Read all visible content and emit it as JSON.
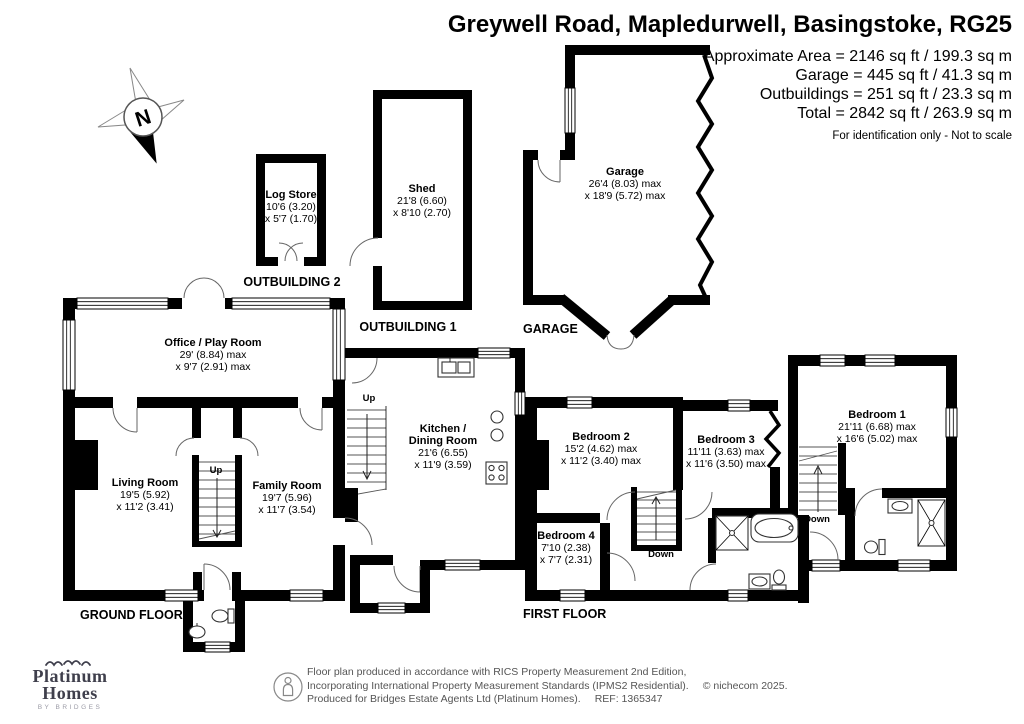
{
  "title": "Greywell Road, Mapledurwell, Basingstoke, RG25",
  "areas": {
    "approximate": "Approximate Area = 2146 sq ft / 199.3 sq m",
    "garage": "Garage = 445 sq ft / 41.3 sq m",
    "outbuildings": "Outbuildings = 251 sq ft / 23.3 sq m",
    "total": "Total = 2842 sq ft / 263.9 sq m",
    "disclaimer": "For identification only - Not to scale"
  },
  "compass": {
    "north": "N"
  },
  "rooms": {
    "log_store": {
      "name": "Log Store",
      "dim1": "10'6 (3.20)",
      "dim2": "x 5'7 (1.70)"
    },
    "shed": {
      "name": "Shed",
      "dim1": "21'8 (6.60)",
      "dim2": "x 8'10 (2.70)"
    },
    "garage": {
      "name": "Garage",
      "dim1": "26'4 (8.03) max",
      "dim2": "x 18'9 (5.72) max"
    },
    "office_play_room": {
      "name": "Office / Play Room",
      "dim1": "29' (8.84) max",
      "dim2": "x 9'7 (2.91) max"
    },
    "kitchen_dining": {
      "name": "Kitchen /",
      "name2": "Dining Room",
      "dim1": "21'6 (6.55)",
      "dim2": "x 11'9 (3.59)"
    },
    "living_room": {
      "name": "Living Room",
      "dim1": "19'5 (5.92)",
      "dim2": "x 11'2 (3.41)"
    },
    "family_room": {
      "name": "Family Room",
      "dim1": "19'7 (5.96)",
      "dim2": "x 11'7 (3.54)"
    },
    "bedroom_1": {
      "name": "Bedroom 1",
      "dim1": "21'11 (6.68) max",
      "dim2": "x 16'6 (5.02) max"
    },
    "bedroom_2": {
      "name": "Bedroom 2",
      "dim1": "15'2 (4.62) max",
      "dim2": "x 11'2 (3.40) max"
    },
    "bedroom_3": {
      "name": "Bedroom 3",
      "dim1": "11'11 (3.63) max",
      "dim2": "x 11'6 (3.50) max"
    },
    "bedroom_4": {
      "name": "Bedroom 4",
      "dim1": "7'10 (2.38)",
      "dim2": "x 7'7 (2.31)"
    }
  },
  "floor_labels": {
    "outbuilding_2": "OUTBUILDING 2",
    "outbuilding_1": "OUTBUILDING 1",
    "garage": "GARAGE",
    "ground_floor": "GROUND FLOOR",
    "first_floor": "FIRST FLOOR"
  },
  "stairs": {
    "up_main": "Up",
    "up_kitchen": "Up",
    "down_landing": "Down",
    "down_bedroom1": "Down"
  },
  "logo": {
    "name_line1": "Platinum",
    "name_line2": "Homes",
    "tagline": "BY BRIDGES"
  },
  "footer": {
    "line1": "Floor plan produced in accordance with RICS Property Measurement 2nd Edition,",
    "line2": "Incorporating International Property Measurement Standards (IPMS2 Residential).",
    "copyright": "© nichecom 2025.",
    "line3": "Produced for Bridges Estate Agents Ltd (Platinum Homes).",
    "ref": "REF: 1365347"
  },
  "colors": {
    "wall": "#000000",
    "logo": "#3f3f4c",
    "footer_text": "#555555"
  }
}
